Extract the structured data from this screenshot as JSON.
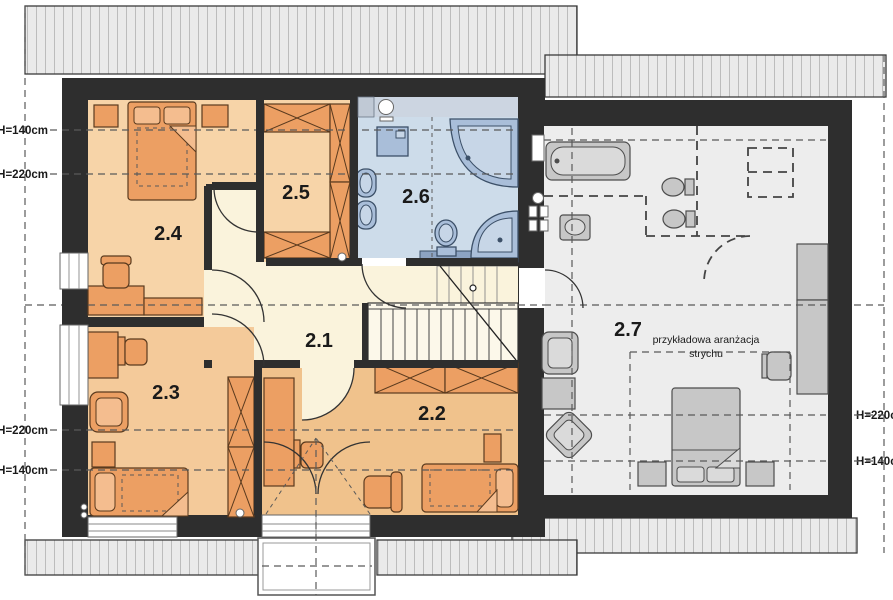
{
  "floorplan": {
    "rooms": [
      {
        "label": "2.1"
      },
      {
        "label": "2.2"
      },
      {
        "label": "2.3"
      },
      {
        "label": "2.4"
      },
      {
        "label": "2.5"
      },
      {
        "label": "2.6"
      },
      {
        "label": "2.7"
      }
    ],
    "attic_note": {
      "line1": "przykładowa aranżacja",
      "line2": "strychu"
    },
    "dimensions": {
      "left": [
        "H=140cm",
        "H=220cm",
        "H=220cm",
        "H=140cm"
      ],
      "right": [
        "H=220cm",
        "H=140cm"
      ]
    }
  },
  "colors": {
    "wall": "#2e2e2e",
    "hall": "#faf3dc",
    "warm_a": "#f7d4a8",
    "warm_b": "#f4ca9a",
    "warm_c": "#f0c28c",
    "bath": "#cddcea",
    "bath_strip": "#ccd5e1",
    "attic": "#ededed",
    "furn": "#ec9f63",
    "furn_light": "#f4bd8f",
    "furn_stroke": "#5a3a1e",
    "fix": "#a9bed9",
    "fix_light": "#c7d6e7",
    "fix_stroke": "#3c5068",
    "gfurn": "#c7c7c7",
    "gfurn_light": "#dadada",
    "gfurn_stroke": "#4d4d4d",
    "roof_fill": "#eaeaea",
    "roof_line": "#8f8f8f",
    "roof_stroke": "#3a3a3a",
    "dash": "#5a5a5a",
    "ink": "#1a1a1a"
  }
}
